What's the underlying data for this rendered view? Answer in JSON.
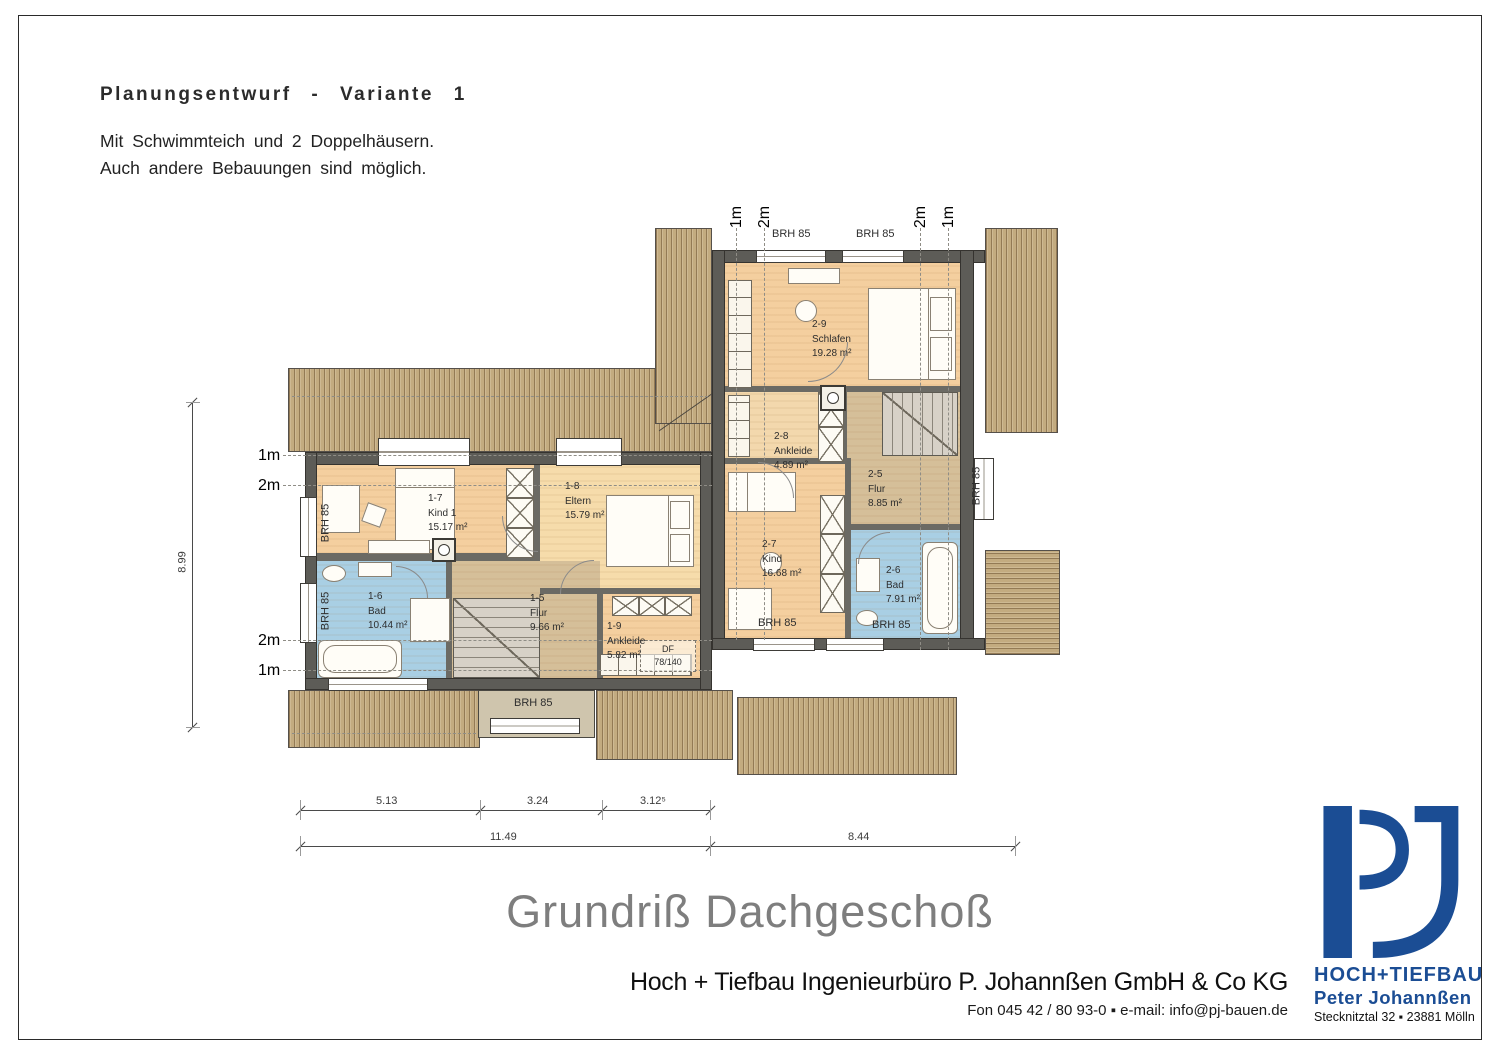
{
  "header": {
    "title": "Planungsentwurf - Variante 1",
    "subtitle1": "Mit Schwimmteich und 2 Doppelhäusern.",
    "subtitle2": "Auch andere Bebauungen sind möglich."
  },
  "plan": {
    "window_label": "BRH 85",
    "df_line1": "DF",
    "df_line2": "78/140",
    "rooms": [
      {
        "id": "1-7",
        "name": "Kind 1",
        "area": "15.17 m²"
      },
      {
        "id": "1-8",
        "name": "Eltern",
        "area": "15.79 m²"
      },
      {
        "id": "1-6",
        "name": "Bad",
        "area": "10.44 m²"
      },
      {
        "id": "1-5",
        "name": "Flur",
        "area": "9.66 m²"
      },
      {
        "id": "1-9",
        "name": "Ankleide",
        "area": "5.82 m²"
      },
      {
        "id": "2-9",
        "name": "Schlafen",
        "area": "19.28 m²"
      },
      {
        "id": "2-8",
        "name": "Ankleide",
        "area": "4.89 m²"
      },
      {
        "id": "2-5",
        "name": "Flur",
        "area": "8.85 m²"
      },
      {
        "id": "2-7",
        "name": "Kind",
        "area": "16.68 m²"
      },
      {
        "id": "2-6",
        "name": "Bad",
        "area": "7.91 m²"
      }
    ],
    "height_marks_left": [
      "1m",
      "2m",
      "2m",
      "1m"
    ],
    "height_marks_top": [
      "1m",
      "2m",
      "2m",
      "1m"
    ],
    "dims": {
      "seg1": "5.13",
      "seg2": "3.24",
      "seg3": "3.12⁵",
      "total_left": "11.49",
      "total_right": "8.44",
      "height": "8.99"
    }
  },
  "footer": {
    "drawing_title": "Grundriß Dachgeschoß",
    "company": "Hoch + Tiefbau Ingenieurbüro P. Johannßen GmbH & Co KG",
    "contact": "Fon 045 42 / 80 93-0  ▪  e-mail: info@pj-bauen.de"
  },
  "logo": {
    "brand_line1": "HOCH+TIEFBAU",
    "brand_line2": "Peter Johannßen",
    "address": "Stecknitztal 32 ▪ 23881 Mölln",
    "color": "#1b4d94"
  }
}
